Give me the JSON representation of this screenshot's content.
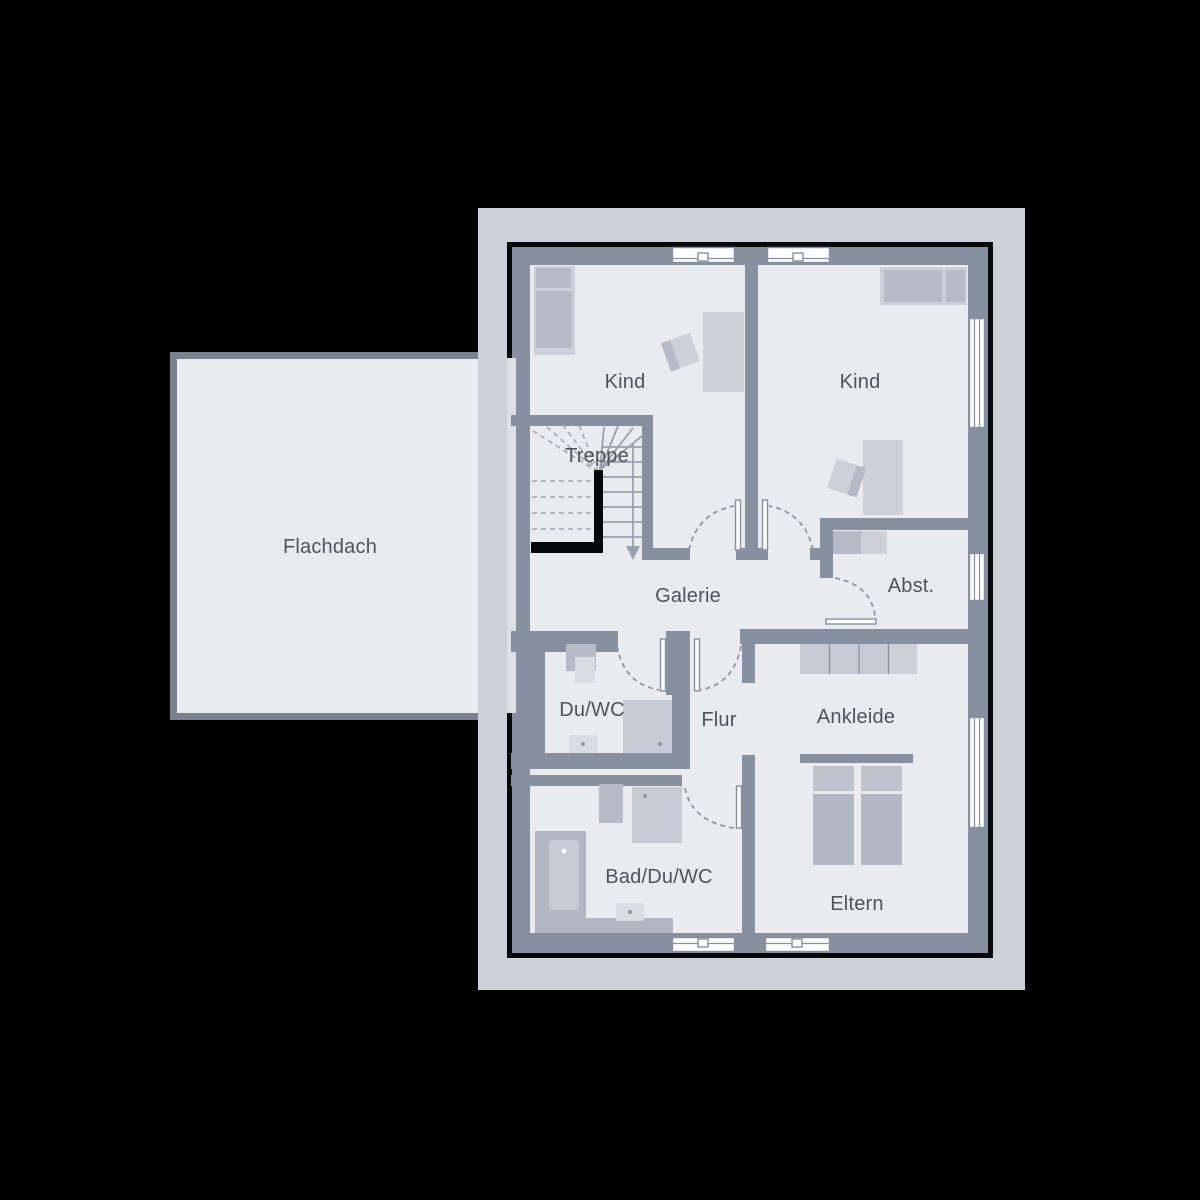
{
  "plan": {
    "kind": "floor-plan",
    "language": "de",
    "rooms": {
      "flachdach": {
        "label": "Flachdach"
      },
      "kind_left": {
        "label": "Kind"
      },
      "kind_right": {
        "label": "Kind"
      },
      "treppe": {
        "label": "Treppe"
      },
      "galerie": {
        "label": "Galerie"
      },
      "abstellraum": {
        "label": "Abst."
      },
      "du_wc": {
        "label": "Du/WC"
      },
      "flur": {
        "label": "Flur"
      },
      "ankleide": {
        "label": "Ankleide"
      },
      "bad_du_wc": {
        "label": "Bad/Du/WC"
      },
      "eltern": {
        "label": "Eltern"
      }
    },
    "colors": {
      "background": "#000000",
      "site_band": "#cdd0d9",
      "wall": "#87909e",
      "floor": "#e9ebef",
      "flat_roof_border": "#7a8290",
      "furniture": "#b4bac6",
      "furniture_light": "#cdd0d8",
      "fixture_light": "#dadce3",
      "stair_parapet": "#07080a",
      "window": "#ffffff",
      "label_text": "#4e545c"
    }
  }
}
